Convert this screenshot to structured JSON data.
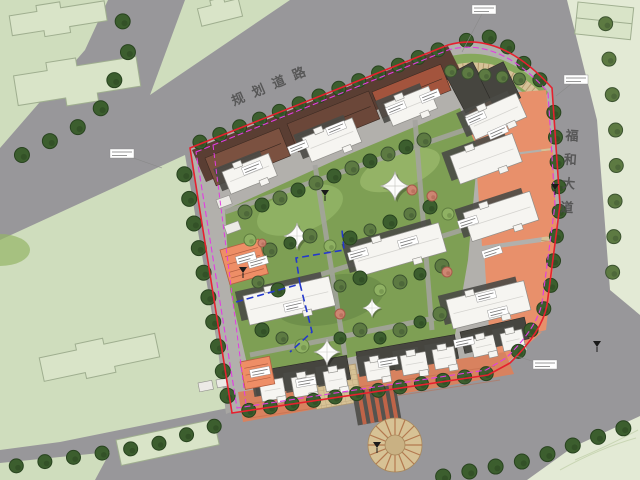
{
  "roads": {
    "north_label": "规划道路",
    "east_label": "福和大道"
  },
  "colors": {
    "road": "#98979a",
    "context_green": "#cfddbd",
    "context_green_light": "#e3ead5",
    "site_pavement": "#b2b0ac",
    "landscape_green": "#7e9f54",
    "podium_brown": "#5a3e33",
    "salmon": "#e8906b",
    "terracotta": "#d8825f",
    "paving_tan": "#d7c295",
    "building_white": "#f6f5f1",
    "boundary_red": "#e6202e",
    "boundary_magenta": "#e23ce2",
    "garage_line_blue": "#2438cc",
    "tree_dark": "#3c5e2e",
    "tree_mid": "#5d7a42",
    "tree_light": "#8fb163"
  },
  "icons": {
    "tree": "scalloped-circle",
    "membrane_canopy": "four-point-sail",
    "entrance_marker": "black-triangle-flag",
    "annotation": "leader-label-box",
    "round_plaza": "radial-fan"
  }
}
